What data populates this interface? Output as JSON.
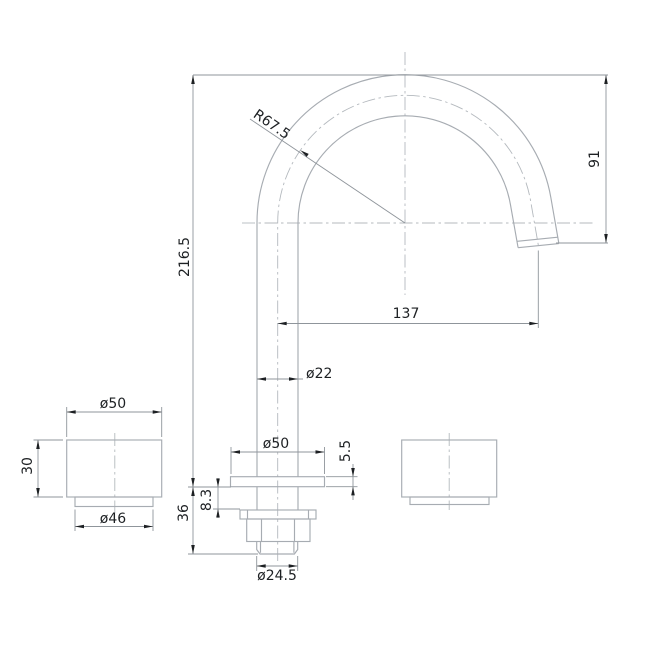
{
  "drawing": {
    "type": "technical-dimension-drawing",
    "subject": "basin spout and handles, front elevation with mounting hardware",
    "colors": {
      "bg": "#ffffff",
      "part": "#a7acb2",
      "center": "#b4b9be",
      "dim": "#8f959b",
      "ink": "#1d2023"
    },
    "labels": {
      "spout_radius": "R67.5",
      "total_height": "216.5",
      "spout_height": "91",
      "spout_reach": "137",
      "pipe_diameter": "ø22",
      "base_plate_diameter": "ø50",
      "base_plate_thickness": "5.5",
      "counter_clearance": "8.3",
      "shank_length": "36",
      "thread_diameter": "ø24.5",
      "handle_diameter": "ø50",
      "handle_height": "30",
      "handle_base_diameter": "ø46"
    }
  }
}
